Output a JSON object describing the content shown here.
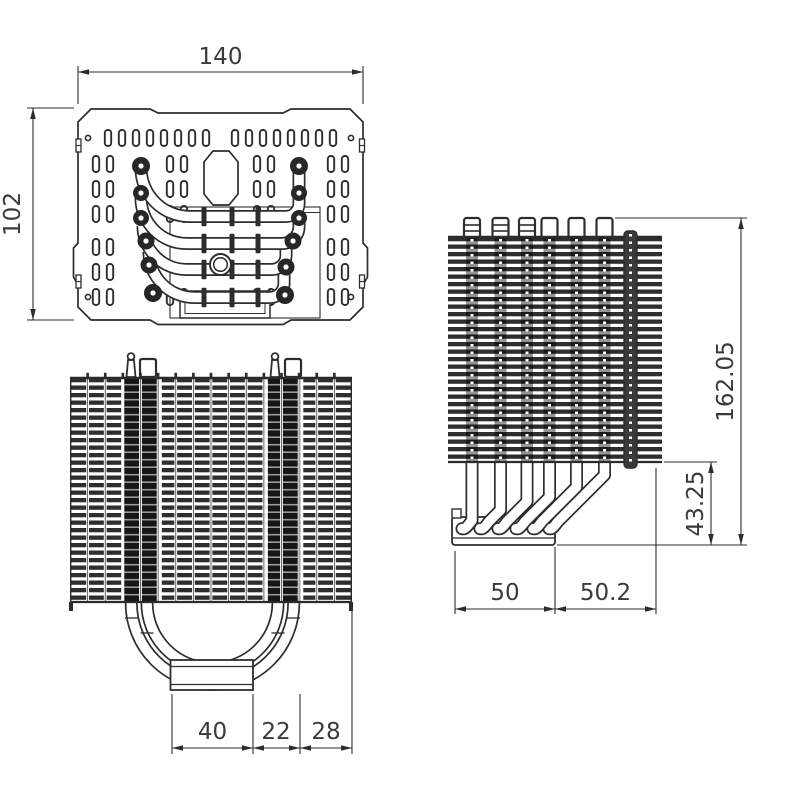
{
  "colors": {
    "background": "#ffffff",
    "line": "#2d2d2d",
    "text": "#3a3a3a"
  },
  "dimensions": {
    "top_view": {
      "width": "140",
      "height": "102"
    },
    "front_view": {
      "base_width": "40",
      "pipe_offset": "22",
      "edge_offset": "28"
    },
    "side_view": {
      "total_height": "162.05",
      "bend_height": "43.25",
      "depth_front": "50",
      "depth_rear": "50.2"
    }
  }
}
